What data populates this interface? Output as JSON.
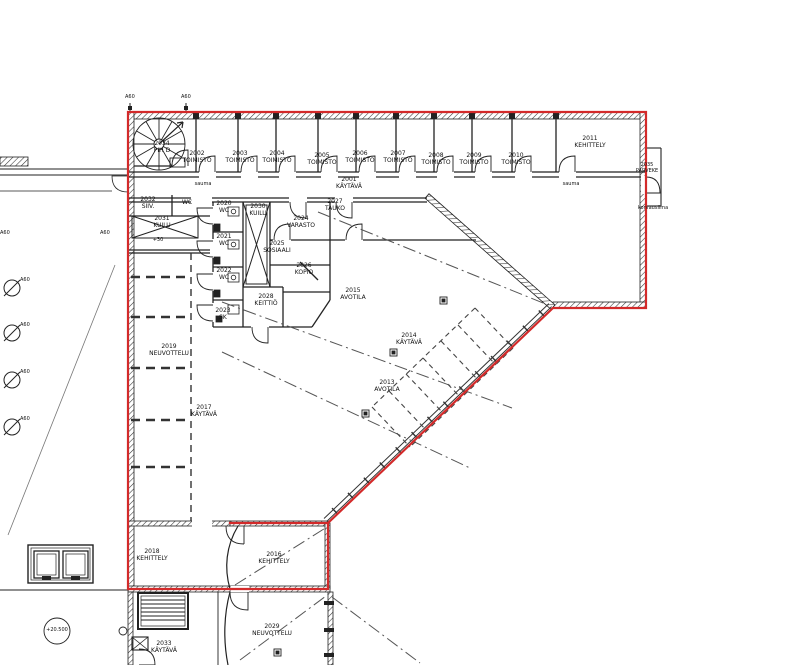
{
  "colors": {
    "boundary_red": "#d32a2a",
    "wall_black": "#222222",
    "zone_gray": "#555555"
  },
  "labels": {
    "t2034": "2034\nPIH D",
    "t2002": "2002\nTOIMISTO",
    "t2003": "2003\nTOIMISTO",
    "t2004": "2004\nTOIMISTO",
    "t2005": "2005\nTOIMISTO",
    "t2006": "2006\nTOIMISTO",
    "t2007": "2007\nTOIMISTO",
    "t2008": "2008\nTOIMISTO",
    "t2009": "2009\nTOIMISTO",
    "t2010": "2010\nTOIMISTO",
    "t2001": "2001\nKÄYTÄVÄ",
    "t2011": "2011\nKEHITTELY",
    "t2035": "2035\nPARVEKE",
    "t2032": "2032\nSIIV.",
    "twc": "WC",
    "t2031": "2031\nKUILU",
    "t2020": "2020\nWC",
    "t2021": "2021\nWC",
    "t2022": "2022\nWC",
    "t2023": "2023\nSK",
    "t2030": "2030\nKUILU",
    "t2024": "2024\nVARASTO",
    "t2025": "2025\nSOSIAALI",
    "t2026": "2026\nKOPIO",
    "t2027": "2027\nTAUKO",
    "t2028": "2028\nKEITTIÖ",
    "t2019": "2019\nNEUVOTTELU",
    "t2017": "2017\nKÄYTÄVÄ",
    "t2018": "2018\nKEHITTELY",
    "t2016": "2016\nKEHITTELY",
    "t2015": "2015\nAVOTILA",
    "t2014": "2014\nKÄYTÄVÄ",
    "t2013": "2013\nAVOTILA",
    "t2029": "2029\nNEUVOTTELU",
    "t2033": "2033\nKÄYTÄVÄ",
    "a60": "A60",
    "plus30": "+30",
    "sauma": "sauma",
    "korvausilma": "korvausilma",
    "elevation": "+20.500"
  }
}
